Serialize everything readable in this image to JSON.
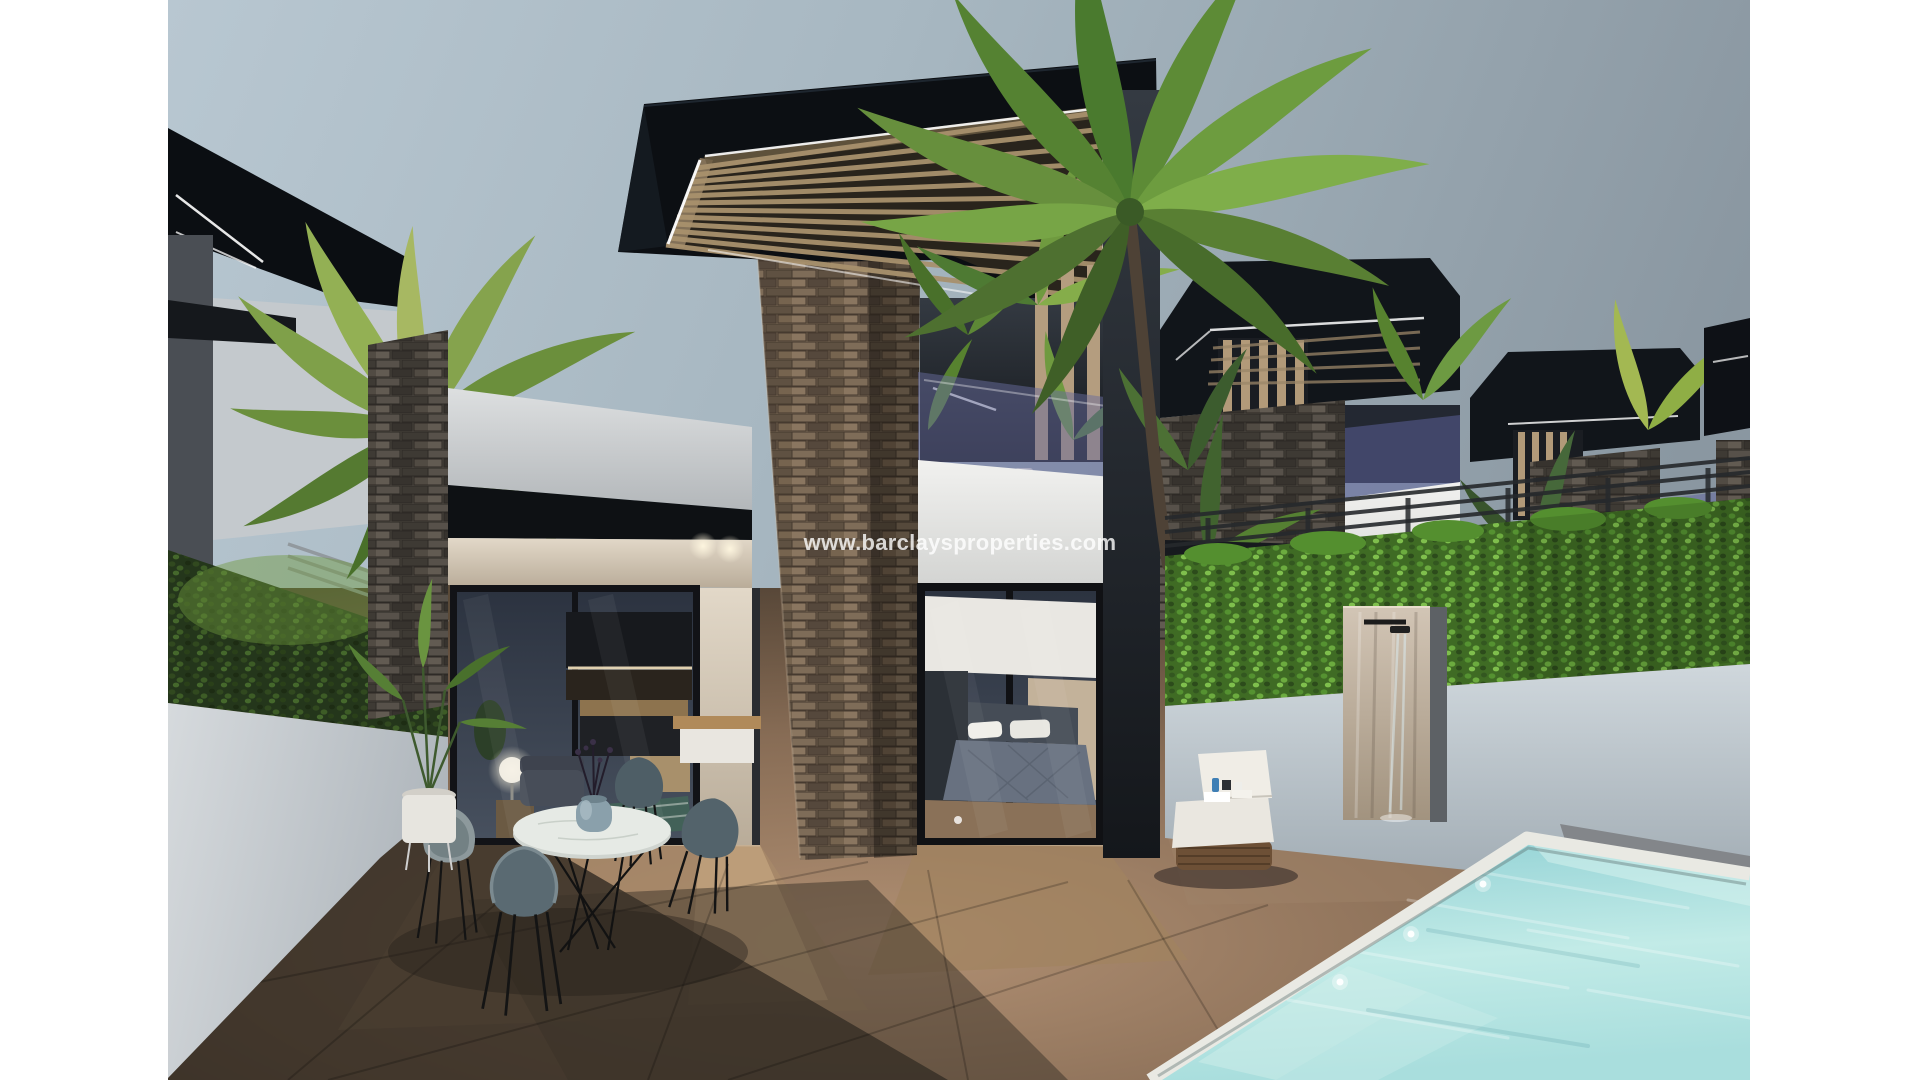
{
  "canvas": {
    "width": 1920,
    "height": 1080,
    "background": "#ffffff"
  },
  "photo": {
    "left": 168,
    "width": 1582,
    "height": 1080,
    "type": "3d-architectural-render",
    "scene": "Modern two-storey villas at dusk with pergola roofs, stacked-stone columns, glass doors, terrace dining set, sun lounger, outdoor shower, green hedges, palm trees and a private turquoise pool",
    "watermark": {
      "text": "www.barclaysproperties.com",
      "color": "#ffffff",
      "opacity": 0.8
    },
    "palette": {
      "sky_top": "#b7c6d0",
      "sky_right": "#8a97a1",
      "roof_black": "#0d1116",
      "stone_brown": "#6f5f4e",
      "stone_gray": "#4a453f",
      "wall_white": "#d9dbdc",
      "hedge_dark": "#2e4420",
      "hedge_bright": "#4c7d2c",
      "terrace_tan": "#8a6f57",
      "pool_water": "#9fd9d9",
      "pool_coping": "#e9e9e3",
      "wood_slat": "#a8916d",
      "chair_gray_blue": "#5a6a72",
      "lounger_white": "#eae7e0",
      "led_strip": "#ffffff"
    },
    "objects": [
      "sky",
      "left-villa",
      "boundary-hedge-left",
      "palm-tree-left",
      "main-villa",
      "pergola-roof",
      "stone-column",
      "upper-balcony",
      "bedroom-glass-doors",
      "living-glass-doors",
      "palm-tree-center",
      "right-villa-1",
      "right-villa-2",
      "right-villa-3",
      "boundary-hedge-right",
      "outdoor-shower",
      "swimming-pool",
      "sun-lounger",
      "dining-set",
      "terrace"
    ]
  }
}
